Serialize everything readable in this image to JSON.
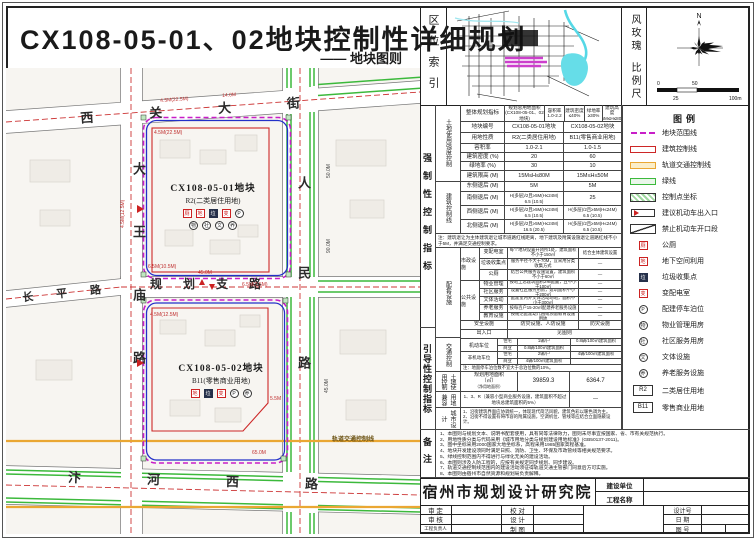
{
  "title": {
    "main": "CX108-05-01、02地块控制性详细规划",
    "sub": "—— 地块图则"
  },
  "map": {
    "streets": {
      "xiguan": "西关大街",
      "renmin": "人民路",
      "dawangmiao": "大王庙路",
      "guihua": "规划支路",
      "bianhe": "汴河西路",
      "changping": "长平路"
    },
    "rail_label": "轨道交通控制线",
    "parcel1": {
      "code": "CX108-05-01地块",
      "use": "R2(二类居住用地)",
      "icons_a": [
        "厕",
        "地",
        "垃",
        "变",
        "P"
      ],
      "icons_b": [
        "物",
        "社",
        "文",
        "养"
      ]
    },
    "parcel2": {
      "code": "CX108-05-02地块",
      "use": "B11(零售商业用地)",
      "icons": [
        "地",
        "垃",
        "变",
        "P",
        "养"
      ]
    },
    "dims": [
      "4.5M(22.5M)",
      "14.0M",
      "4.5M(22.5M)",
      "4.5M(12.5M)",
      "6.5M(10.5M)",
      "45.0M",
      "6.5M(2.5M)",
      "50.0M",
      "90.0M",
      "4.5M(12.5M)",
      "45.0M",
      "65.0M",
      "5.5M"
    ]
  },
  "panel": {
    "loc_label": "区位索引",
    "rose_label": "风玫瑰",
    "scale_label": "比例尺",
    "rose_n": "N",
    "scale": {
      "t0": "0",
      "t50": "50",
      "t25": "25",
      "t100": "100m"
    }
  },
  "table": {
    "sec1": "强制性控制指标",
    "sec2": "引导性控制指标",
    "g1": "土地使用强度控制",
    "g2": "建筑控制线",
    "g3": "配套设施",
    "g3a": "市政设施",
    "g3b": "公共设施",
    "g4": "交通控制",
    "g5": "土地使用控制",
    "g6": "用地兼容",
    "g7": "城市设计",
    "r1": {
      "label": "整体规划指标",
      "c1a": "规划总用地面积",
      "c1b": "(CX108-05-01、02地块)",
      "c2a": "容积率",
      "c2b": "1.0-2.2",
      "c3a": "建筑密度",
      "c3b": "≤40%",
      "c4a": "绿地率",
      "c4b": "≥30%",
      "c5a": "建筑高度",
      "c5b": "15M≤H≤80M"
    },
    "r2": {
      "label": "地块编号",
      "c1": "CX108-05-01地块",
      "c2": "CX108-05-02地块"
    },
    "r3": {
      "label": "用地性质",
      "c1": "R2(二类居住用地)",
      "c2": "B11(零售商业用地)"
    },
    "r4": {
      "label": "容积率",
      "c1": "1.0-2.1",
      "c2": "1.0-1.5"
    },
    "r5": {
      "label": "建筑密度 (%)",
      "c1": "20",
      "c2": "60"
    },
    "r6": {
      "label": "绿地率 (%)",
      "c1": "30",
      "c2": "10"
    },
    "r7": {
      "label": "建筑限高 (M)",
      "c1": "15M≤H≤80M",
      "c2": "15M≤H≤50M"
    },
    "r8": {
      "label": "东侧退后 (M)",
      "c1": "5M",
      "c2": "5M"
    },
    "r9": {
      "label": "南侧退后 (M)",
      "c1": "H(多层)/2且≥5M(H≤24M)\n6.5 (10.5)",
      "c2": "25"
    },
    "r10": {
      "label": "西侧退后 (M)",
      "c1": "H(多层)/2且≥5M(H≤24M)\n6.5 (10.5)",
      "c2": "H(多层)/2且≥5M(H≤24M)\n6.5 (10.5)"
    },
    "r11": {
      "label": "北侧退后 (M)",
      "c1": "H(多层)/2且≥5M(H≤24M)\n16.5 (20.5)",
      "c2": "H(多层)/2且≥5M(H≤24M)\n6.5 (10.5)"
    },
    "note1": "注：建筑退让为主体建筑退让城市道路红线距离，地下建筑及附属设施退让道路红线不小于5M，并满足交通控制要求。",
    "m1": {
      "label": "变配电室",
      "c1": "每个地块设置开闭所1处，建筑面积不小于150㎡",
      "c2": "结合主体建筑设置"
    },
    "m2": {
      "label": "垃圾收集点",
      "c1": "服务半径不大于70M，宜采用分类收集方式",
      "c2": "—"
    },
    "m3": {
      "label": "公厕",
      "c1": "结合公共服务设施设置，建筑面积不小于60㎡",
      "c2": "—"
    },
    "p1": {
      "label": "物业管理",
      "c1": "按地上总建筑面积2‰配置，且不小于100㎡",
      "c2": "—"
    },
    "p2": {
      "label": "社区服务",
      "c1": "设置社区服务用房，建筑面积不小于200㎡",
      "c2": "—"
    },
    "p3": {
      "label": "文体活动",
      "c1": "配建室内外文体活动场地，面积不小于300㎡",
      "c2": "—"
    },
    "p4": {
      "label": "养老服务",
      "c1": "按每百户15-20㎡配建养老服务设施",
      "c2": "—"
    },
    "p5": {
      "label": "教育设施",
      "c1": "按规范配建幼儿园或预留教育设施用地",
      "c2": "—"
    },
    "s1": {
      "label": "安全设施",
      "c1": "防灾设施、人防设施",
      "c2": "防灾设施"
    },
    "t1": {
      "label": "出入口",
      "c": "见图则"
    },
    "t2": {
      "label": "机动车位",
      "s1": "住宅",
      "v1": "1辆/户",
      "s2": "商业",
      "v2": "0.8辆/100㎡建筑面积",
      "c2": "0.8辆/100㎡建筑面积"
    },
    "t3": {
      "label": "非机动车位",
      "s1": "住宅",
      "v1": "2辆/户",
      "s2": "商业",
      "v2": "4辆/100㎡建筑面积",
      "c2": "4辆/100㎡建筑面积"
    },
    "t4": "注：地面停车泊位数不宜大于总泊位数的10%。",
    "l1": {
      "label": "规划用地面积\n（㎡）",
      "sub": "（净用地面积）",
      "c1": "39859.3",
      "c2": "6364.7"
    },
    "u1": {
      "c1": "1、3、R（兼容小型商业服务设施，建筑面积不超过地块总建筑面积的5%）",
      "c2": "—"
    },
    "d1": "1、沿街建筑界面应协调统一，体现现代简洁风貌，建筑色彩以暖色调为主。",
    "d2": "2、沿街不得设置有碍市容的附属设施，空调机位、管线等应结合立面隐蔽设计。"
  },
  "legend": {
    "title": "图例",
    "items": [
      {
        "label": "地块范围线"
      },
      {
        "label": "建筑控制线"
      },
      {
        "label": "轨道交通控制线"
      },
      {
        "label": "绿线"
      },
      {
        "label": "控制点坐标"
      },
      {
        "label": "建议机动车出入口"
      },
      {
        "label": "禁止机动车开口段"
      },
      {
        "label": "公厕",
        "glyph": "厕"
      },
      {
        "label": "地下空间利用",
        "glyph": "地"
      },
      {
        "label": "垃圾收集点",
        "glyph": "垃"
      },
      {
        "label": "变配电室",
        "glyph": "变"
      },
      {
        "label": "配建停车泊位",
        "glyph": "P"
      },
      {
        "label": "物业管理用房",
        "glyph": "物"
      },
      {
        "label": "社区服务用房",
        "glyph": "社"
      },
      {
        "label": "文体设施",
        "glyph": "文"
      },
      {
        "label": "养老服务设施",
        "glyph": "养"
      },
      {
        "label": "二类居住用地",
        "glyph": "R2"
      },
      {
        "label": "零售商业用地",
        "glyph": "B11"
      }
    ]
  },
  "notes": {
    "label": "备注",
    "lines": [
      "1、本图则与规划文本、说明书配套使用，具有同等法律效力，图则未尽事宜按国家、省、市有关规范执行。",
      "2、用地性质分类与代码采用《城市用地分类与规划建设用地标准》(GB50137-2011)。",
      "3、图中坐标采用2000国家大地坐标系，高程采用1985国家高程基准。",
      "4、地块开发建设须同时满足日照、消防、卫生、环保及市政管线等相关规范要求。",
      "5、绿线控制范围内不得进行与绿化无关的建设活动。",
      "6、本图则涉及人防工程的，应按有关规定同步规划、同步建设。",
      "7、轨道交通控制线范围内的建设活动须征得轨道交通主管部门同意后方可实施。",
      "8、本图则由宿州市自然资源和规划局负责解释。"
    ]
  },
  "tblock": {
    "institute": "宿州市规划设计研究院",
    "build_unit": "建设单位",
    "project_name": "工程名称",
    "shending": "审 定",
    "jiaodui": "校 对",
    "shenhe": "审 核",
    "sheji": "设 计",
    "fuzeren": "工程负责人",
    "zhitu": "制 图",
    "design_no": "设计号",
    "date": "日 期",
    "fig_no": "图 号"
  }
}
